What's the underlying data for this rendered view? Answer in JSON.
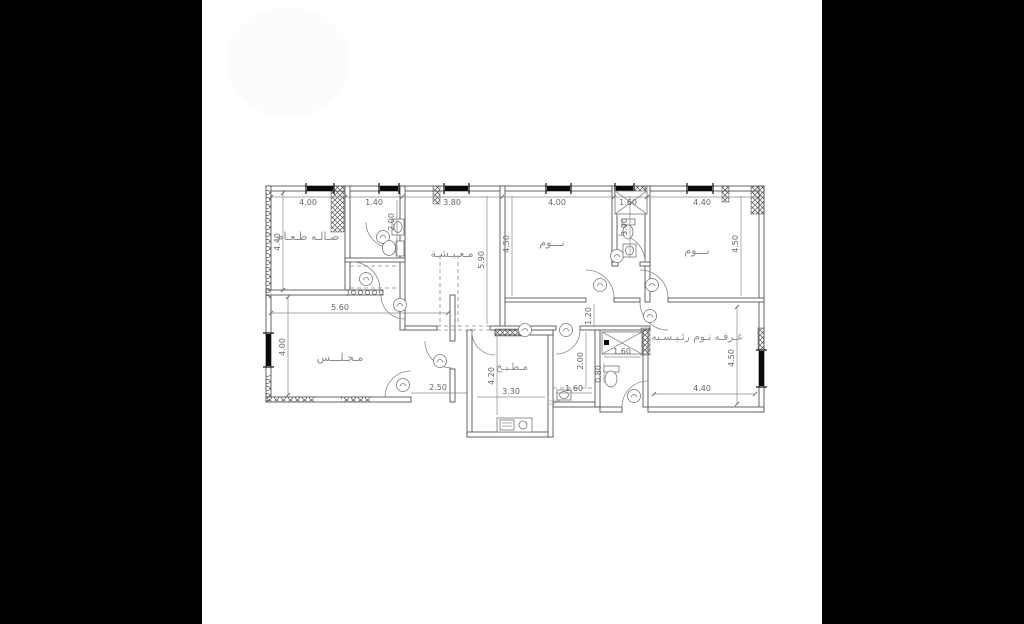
{
  "page": {
    "background_color": "#000000",
    "canvas_color": "#ffffff",
    "type_note": "architectural floor plan drawing"
  },
  "plan": {
    "rooms": {
      "dining": {
        "label": "صـالـه طـعـام"
      },
      "living": {
        "label": "مـعـيـشـة"
      },
      "bed1": {
        "label": "نـــوم"
      },
      "bed2": {
        "label": "نـــوم"
      },
      "majlis": {
        "label": "مـجـلـــس"
      },
      "kitchen": {
        "label": "مـطـبـخ"
      },
      "master": {
        "label": "غـرفـه نـوم رئـيـسـيه"
      }
    },
    "dims": {
      "top_dining": "4.00",
      "top_bath1": "1.40",
      "top_living": "3.80",
      "top_bed1": "4.00",
      "top_bath2": "1.60",
      "top_bed2": "4.40",
      "bath1_h": "2.00",
      "dining_v": "4.40",
      "living_v": "5.90",
      "bed1_v": "4.50",
      "bath2_v": "3.00",
      "bed2_v": "4.50",
      "majlis_w": "5.60",
      "majlis_v": "4.00",
      "hall_v": "1.20",
      "entry_w": "2.50",
      "kitchen_v": "4.20",
      "kitchen_w": "3.30",
      "wc_v": "2.00",
      "wc_w": "1.60",
      "shower_w": "1.60",
      "mbath_v": "0.80",
      "master_w": "4.40",
      "master_v": "4.50"
    }
  }
}
